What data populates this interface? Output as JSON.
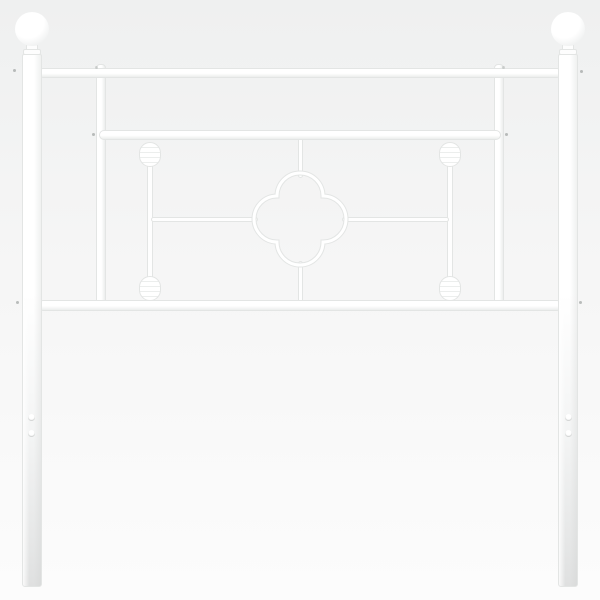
{
  "scene": {
    "type": "product-photo",
    "description": "Studio product photograph of a white metal bed headboard with ball finials, three horizontal rails, a central quatrefoil ornament, two turned spindles and mounting holes in the legs, on a plain light background"
  },
  "colors": {
    "background_top": "#eff0f0",
    "background_mid": "#f6f6f6",
    "background_bottom": "#fcfcfc",
    "metal_white": "#ffffff",
    "metal_edge": "#e3e5e4",
    "metal_shadow": "#eceeed",
    "leg_shade": "#e5e6e6",
    "joint_dot": "#878d8a"
  },
  "parts": {
    "headboard": "white metal headboard",
    "finial_left": "left ball finial",
    "finial_right": "right ball finial",
    "post_left": "left post leg",
    "post_right": "right post leg",
    "rail_top": "top rail",
    "rail_middle": "middle rail",
    "rail_bottom": "bottom rail",
    "bar_inner_left": "inner left upright",
    "bar_inner_right": "inner right upright",
    "spindle_left": "left turned spindle",
    "spindle_right": "right turned spindle",
    "quatrefoil": "quatrefoil center ornament",
    "rod_left": "left connecting rod",
    "rod_right": "right connecting rod",
    "rod_upper": "upper connecting rod",
    "rod_lower": "lower connecting rod",
    "holes_left": "left leg mounting holes",
    "holes_right": "right leg mounting holes"
  }
}
